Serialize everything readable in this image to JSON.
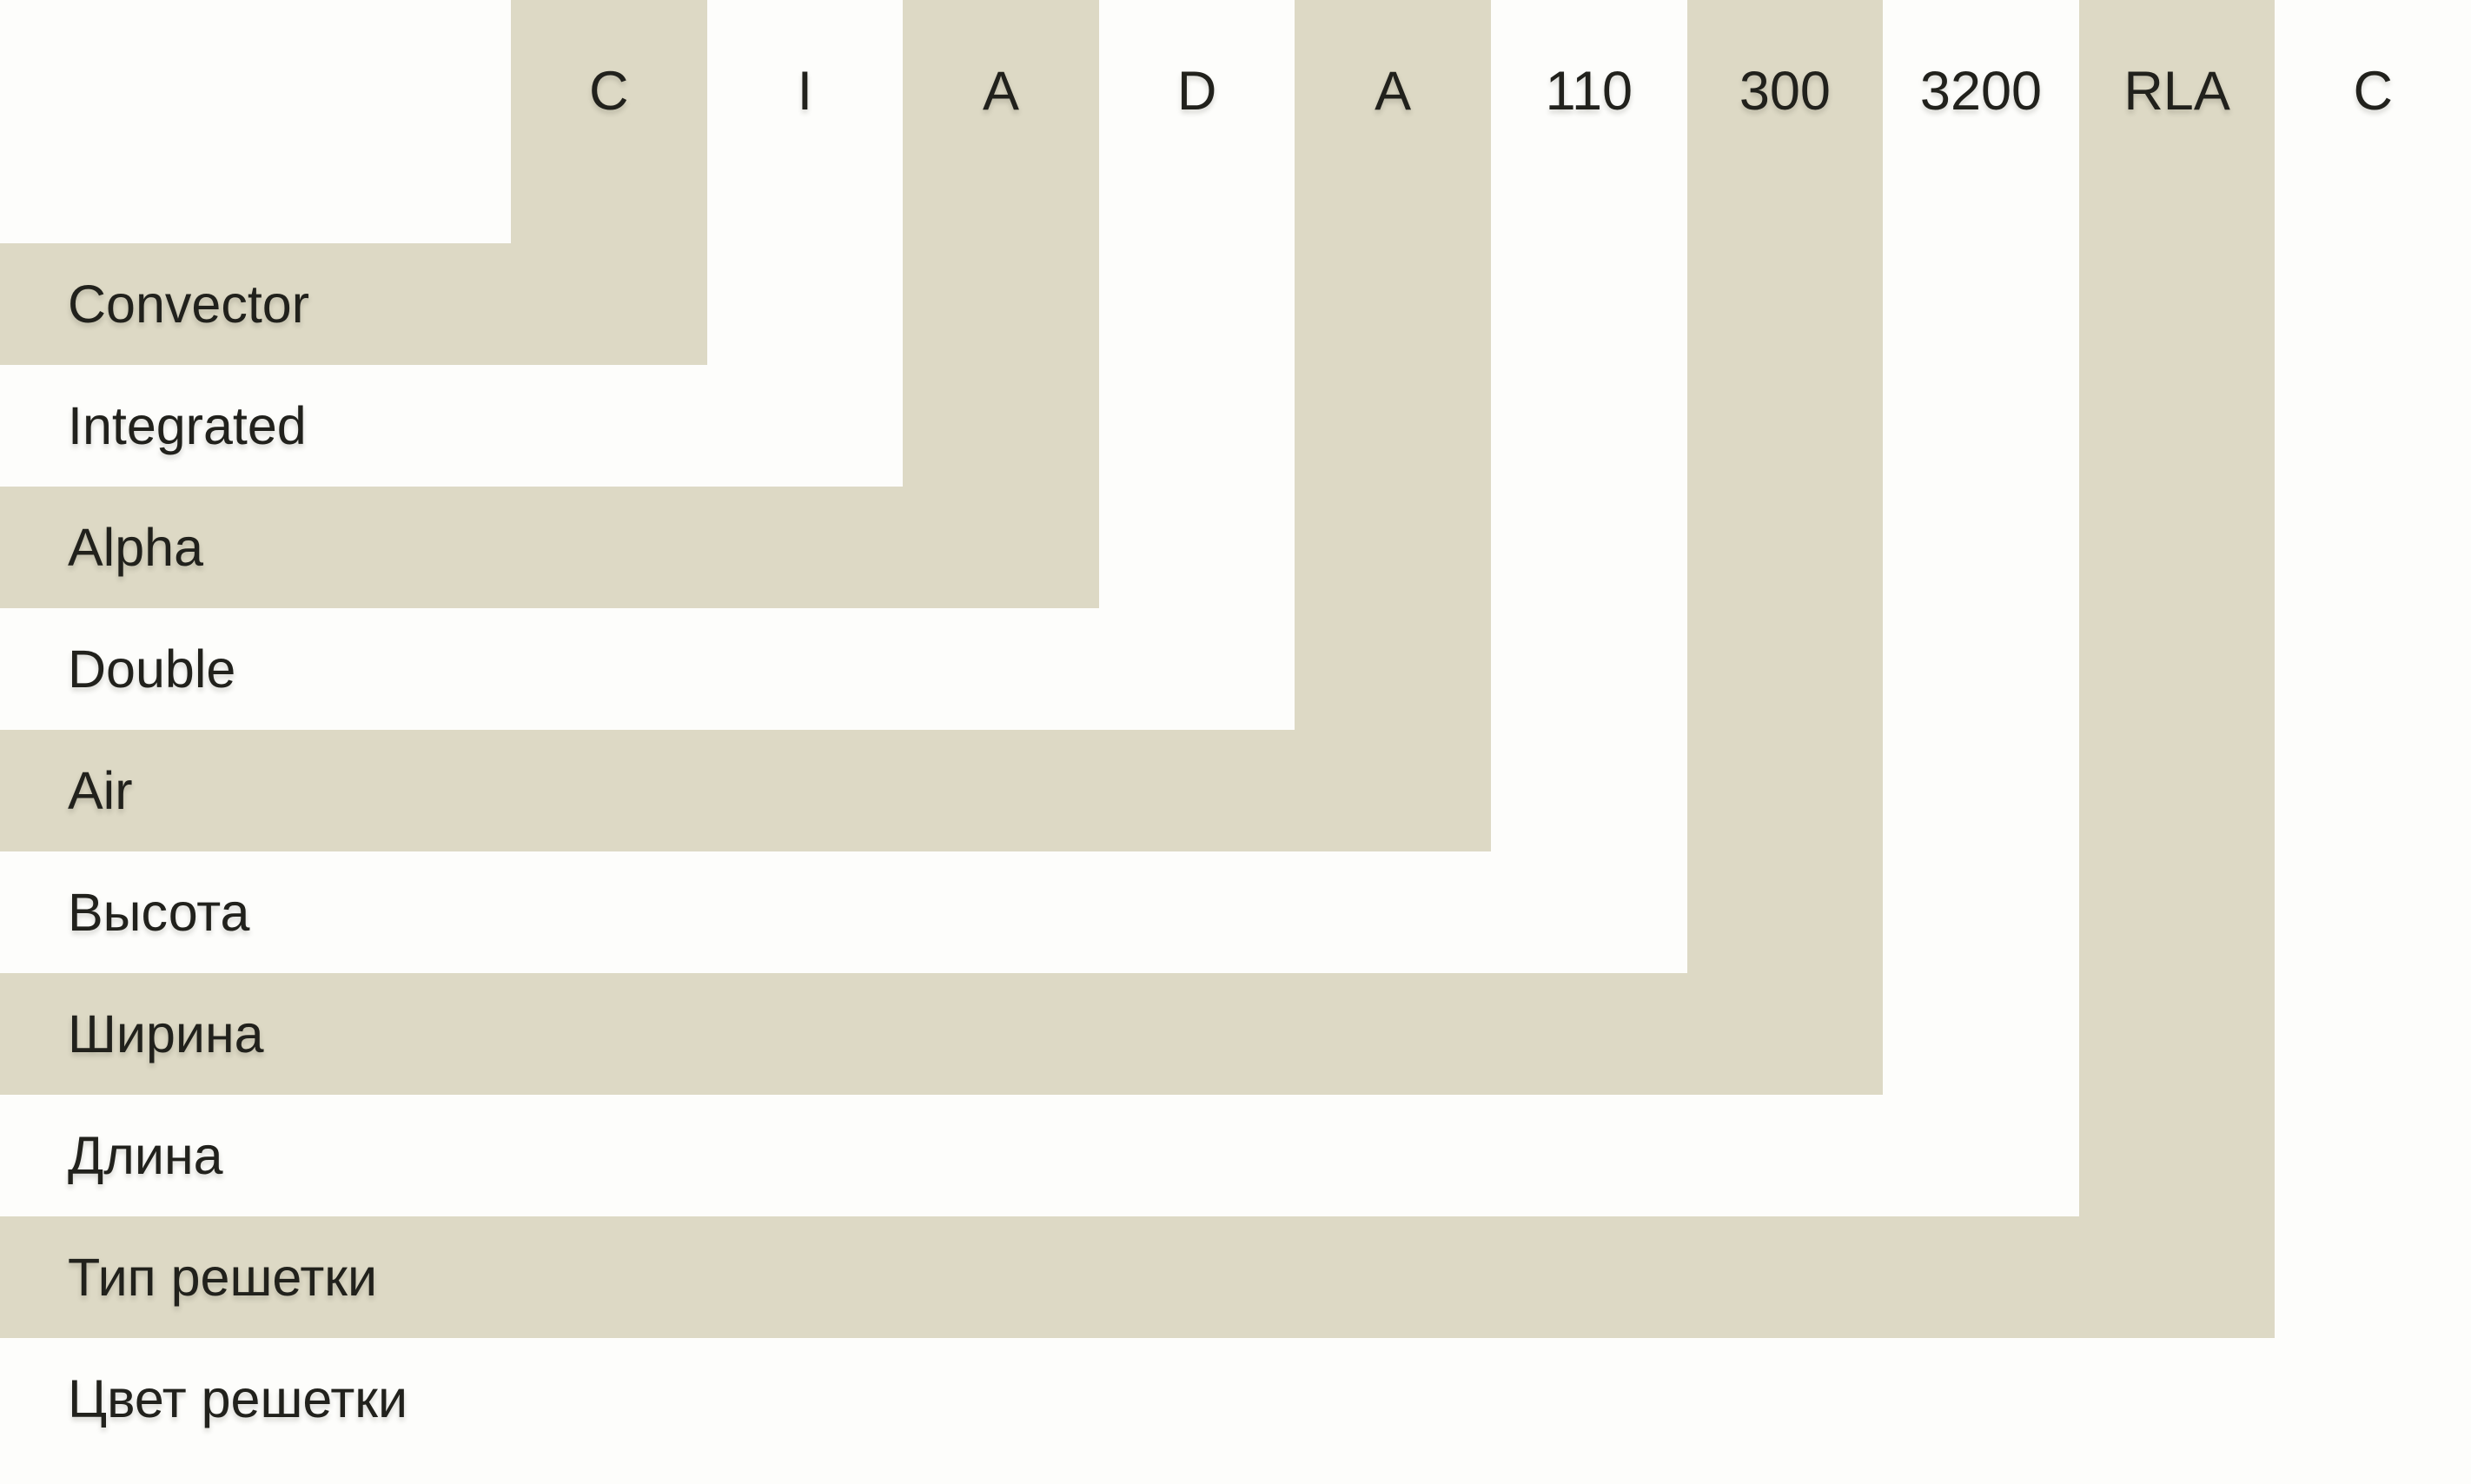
{
  "colors": {
    "beige": "#ddd9c5",
    "background": "#fdfdfb",
    "text": "#21211c"
  },
  "legend": {
    "items": [
      {
        "code": "C",
        "label": "Convector"
      },
      {
        "code": "I",
        "label": "Integrated"
      },
      {
        "code": "A",
        "label": "Alpha"
      },
      {
        "code": "D",
        "label": "Double"
      },
      {
        "code": "A",
        "label": "Air"
      },
      {
        "code": "110",
        "label": "Высота"
      },
      {
        "code": "300",
        "label": "Ширина"
      },
      {
        "code": "3200",
        "label": "Длина"
      },
      {
        "code": "RLA",
        "label": "Тип решетки"
      },
      {
        "code": "C",
        "label": "Цвет решетки"
      }
    ]
  }
}
